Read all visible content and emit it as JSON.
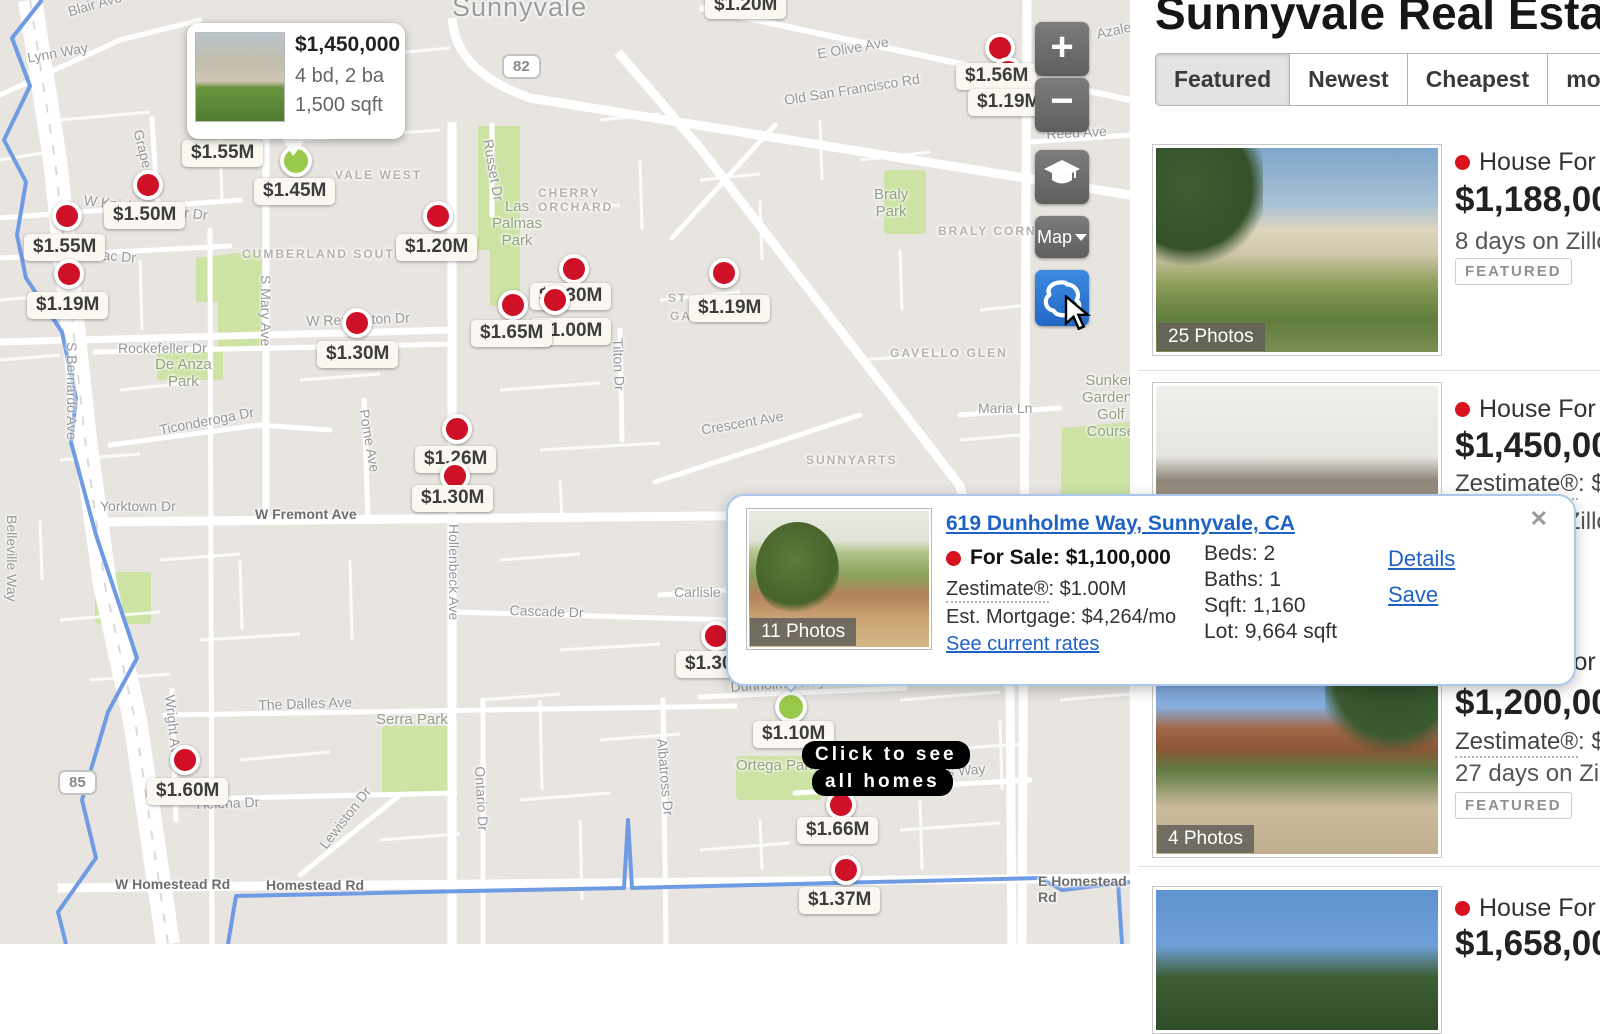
{
  "map": {
    "city": "Sunnyvale",
    "hover_card": {
      "price": "$1,450,000",
      "beds_baths": "4 bd, 2 ba",
      "sqft": "1,500 sqft"
    },
    "click_tooltip": {
      "line1": "Click to see",
      "line2": "all homes"
    },
    "controls": {
      "zoom_in": "+",
      "zoom_out": "−",
      "map_type": "Map"
    },
    "shields": [
      {
        "text": "82",
        "x": 502,
        "y": 54
      },
      {
        "text": "85",
        "x": 58,
        "y": 770
      }
    ],
    "labels": [
      {
        "text": "Blair Ave",
        "x": 66,
        "y": 4,
        "rot": -16,
        "kind": "street"
      },
      {
        "text": "Lynn Way",
        "x": 26,
        "y": 50,
        "rot": -10,
        "kind": "street"
      },
      {
        "text": "Grape Ave",
        "x": 146,
        "y": 128,
        "rot": 76,
        "kind": "street"
      },
      {
        "text": "W Knickerbocker Dr",
        "x": 85,
        "y": 192,
        "rot": 7,
        "kind": "street"
      },
      {
        "text": "Merrimac Dr",
        "x": 60,
        "y": 243,
        "rot": 5,
        "kind": "street"
      },
      {
        "text": "S Bernardo Ave",
        "x": 80,
        "y": 342,
        "rot": 90,
        "kind": "street"
      },
      {
        "text": "Rockefeller Dr",
        "x": 118,
        "y": 340,
        "rot": 0,
        "kind": "street"
      },
      {
        "text": "De Anza\nPark",
        "x": 155,
        "y": 356,
        "rot": 0,
        "kind": "park"
      },
      {
        "text": "Ticonderoga Dr",
        "x": 158,
        "y": 422,
        "rot": -11,
        "kind": "street"
      },
      {
        "text": "Yorktown Dr",
        "x": 100,
        "y": 498,
        "rot": 0,
        "kind": "street"
      },
      {
        "text": "W Fremont Ave",
        "x": 255,
        "y": 506,
        "rot": 0,
        "kind": "street-dark"
      },
      {
        "text": "Belleville Way",
        "x": 20,
        "y": 515,
        "rot": 90,
        "kind": "street"
      },
      {
        "text": "S Mary Ave",
        "x": 274,
        "y": 275,
        "rot": 90,
        "kind": "street"
      },
      {
        "text": "Pome Ave",
        "x": 372,
        "y": 408,
        "rot": 80,
        "kind": "street"
      },
      {
        "text": "Hollenbeck Ave",
        "x": 462,
        "y": 524,
        "rot": 90,
        "kind": "street"
      },
      {
        "text": "Cascade Dr",
        "x": 510,
        "y": 602,
        "rot": 2,
        "kind": "street"
      },
      {
        "text": "Carlisle",
        "x": 674,
        "y": 584,
        "rot": 0,
        "kind": "street"
      },
      {
        "text": "The Dalles Ave",
        "x": 258,
        "y": 697,
        "rot": -2,
        "kind": "street"
      },
      {
        "text": "Serra Park",
        "x": 376,
        "y": 711,
        "rot": 0,
        "kind": "park"
      },
      {
        "text": "Wright Ave",
        "x": 178,
        "y": 694,
        "rot": 84,
        "kind": "street"
      },
      {
        "text": "Helena Dr",
        "x": 196,
        "y": 796,
        "rot": -2,
        "kind": "street"
      },
      {
        "text": "Lewiston Dr",
        "x": 316,
        "y": 842,
        "rot": -52,
        "kind": "street"
      },
      {
        "text": "W Homestead Rd",
        "x": 115,
        "y": 876,
        "rot": 0,
        "kind": "street-dark"
      },
      {
        "text": "Homestead Rd",
        "x": 266,
        "y": 877,
        "rot": 0,
        "kind": "street-dark"
      },
      {
        "text": "Ontario Dr",
        "x": 488,
        "y": 766,
        "rot": 87,
        "kind": "street"
      },
      {
        "text": "Albatross Dr",
        "x": 670,
        "y": 738,
        "rot": 85,
        "kind": "street"
      },
      {
        "text": "Dunholme Way",
        "x": 730,
        "y": 679,
        "rot": -4,
        "kind": "street"
      },
      {
        "text": "Ortega Park",
        "x": 736,
        "y": 757,
        "rot": 0,
        "kind": "park"
      },
      {
        "text": "Inverness Way",
        "x": 893,
        "y": 767,
        "rot": -4,
        "kind": "street"
      },
      {
        "text": "E Homestead Rd",
        "x": 1038,
        "y": 873,
        "rot": 0,
        "kind": "street-dark"
      },
      {
        "text": "Tilton Dr",
        "x": 626,
        "y": 338,
        "rot": 88,
        "kind": "street"
      },
      {
        "text": "Russet Dr",
        "x": 496,
        "y": 138,
        "rot": 80,
        "kind": "street"
      },
      {
        "text": "Las\nPalmas\nPark",
        "x": 492,
        "y": 198,
        "rot": 0,
        "kind": "park"
      },
      {
        "text": "CHERRY\nORCHARD",
        "x": 538,
        "y": 186,
        "rot": 0,
        "kind": "area"
      },
      {
        "text": "Braly\nPark",
        "x": 874,
        "y": 186,
        "rot": 0,
        "kind": "park"
      },
      {
        "text": "BRALY CORNERS",
        "x": 938,
        "y": 224,
        "rot": 0,
        "kind": "area"
      },
      {
        "text": "GAVELLO GLEN",
        "x": 890,
        "y": 346,
        "rot": 0,
        "kind": "area"
      },
      {
        "text": "Maria Ln",
        "x": 978,
        "y": 400,
        "rot": 0,
        "kind": "street"
      },
      {
        "text": "Crescent Ave",
        "x": 700,
        "y": 422,
        "rot": -10,
        "kind": "street"
      },
      {
        "text": "SUNNYARTS",
        "x": 806,
        "y": 453,
        "rot": 0,
        "kind": "area"
      },
      {
        "text": "Sunken\nGardens\nGolf\nCourse",
        "x": 1082,
        "y": 372,
        "rot": 0,
        "kind": "park"
      },
      {
        "text": "E Olive Ave",
        "x": 816,
        "y": 46,
        "rot": -10,
        "kind": "street"
      },
      {
        "text": "Old San Francisco Rd",
        "x": 783,
        "y": 92,
        "rot": -9,
        "kind": "street"
      },
      {
        "text": "Reed Ave",
        "x": 1046,
        "y": 126,
        "rot": -3,
        "kind": "street"
      },
      {
        "text": "Azalea",
        "x": 1095,
        "y": 26,
        "rot": -12,
        "kind": "street"
      },
      {
        "text": "VALE WEST",
        "x": 335,
        "y": 168,
        "rot": 0,
        "k": "",
        "kind": "area"
      },
      {
        "text": "CUMBERLAND SOUTH",
        "x": 242,
        "y": 247,
        "rot": 0,
        "kind": "area"
      },
      {
        "text": "ST",
        "x": 668,
        "y": 291,
        "rot": 0,
        "kind": "area"
      },
      {
        "text": "GARDENS",
        "x": 670,
        "y": 309,
        "rot": 0,
        "kind": "area"
      },
      {
        "text": "W Remington Dr",
        "x": 306,
        "y": 313,
        "rot": -2,
        "kind": "street"
      },
      {
        "text": "Sunnyvale",
        "x": 452,
        "y": -8,
        "rot": 0,
        "kind": "city"
      }
    ],
    "price_points": [
      {
        "kind": "chip",
        "text": "$1.20M",
        "x": 705,
        "y": -8
      },
      {
        "kind": "marker",
        "x": 1000,
        "y": 48,
        "color": "red"
      },
      {
        "kind": "marker",
        "x": 1008,
        "y": 72,
        "color": "red"
      },
      {
        "kind": "chip",
        "text": "$1.56M",
        "x": 956,
        "y": 63
      },
      {
        "kind": "chip",
        "text": "$1.19M",
        "x": 968,
        "y": 89
      },
      {
        "kind": "marker",
        "x": 148,
        "y": 185,
        "color": "red"
      },
      {
        "kind": "chip",
        "text": "$1.50M",
        "x": 104,
        "y": 202
      },
      {
        "kind": "marker",
        "x": 67,
        "y": 216,
        "color": "red"
      },
      {
        "kind": "chip",
        "text": "$1.55M",
        "x": 24,
        "y": 234
      },
      {
        "kind": "marker",
        "x": 69,
        "y": 274,
        "color": "red"
      },
      {
        "kind": "chip",
        "text": "$1.19M",
        "x": 27,
        "y": 292
      },
      {
        "kind": "chip",
        "text": "$1.55M",
        "x": 182,
        "y": 140
      },
      {
        "kind": "marker",
        "x": 296,
        "y": 161,
        "color": "green"
      },
      {
        "kind": "chip",
        "text": "$1.45M",
        "x": 254,
        "y": 178
      },
      {
        "kind": "marker",
        "x": 438,
        "y": 216,
        "color": "red"
      },
      {
        "kind": "chip",
        "text": "$1.20M",
        "x": 396,
        "y": 234
      },
      {
        "kind": "marker",
        "x": 574,
        "y": 269,
        "color": "red"
      },
      {
        "kind": "chip",
        "text": "$1.30M",
        "x": 530,
        "y": 283
      },
      {
        "kind": "marker",
        "x": 555,
        "y": 300,
        "color": "red"
      },
      {
        "kind": "marker",
        "x": 513,
        "y": 305,
        "color": "red"
      },
      {
        "kind": "chip",
        "text": "$1.00M",
        "x": 530,
        "y": 318
      },
      {
        "kind": "chip",
        "text": "$1.65M",
        "x": 471,
        "y": 320
      },
      {
        "kind": "marker",
        "x": 724,
        "y": 273,
        "color": "red"
      },
      {
        "kind": "chip",
        "text": "$1.19M",
        "x": 689,
        "y": 295
      },
      {
        "kind": "marker",
        "x": 357,
        "y": 323,
        "color": "red"
      },
      {
        "kind": "chip",
        "text": "$1.30M",
        "x": 317,
        "y": 341
      },
      {
        "kind": "marker",
        "x": 457,
        "y": 429,
        "color": "red"
      },
      {
        "kind": "chip",
        "text": "$1.26M",
        "x": 415,
        "y": 446
      },
      {
        "kind": "marker",
        "x": 455,
        "y": 476,
        "color": "red"
      },
      {
        "kind": "chip",
        "text": "$1.30M",
        "x": 412,
        "y": 485
      },
      {
        "kind": "marker",
        "x": 185,
        "y": 760,
        "color": "red"
      },
      {
        "kind": "chip",
        "text": "$1.60M",
        "x": 147,
        "y": 778
      },
      {
        "kind": "marker",
        "x": 716,
        "y": 636,
        "color": "red"
      },
      {
        "kind": "chip",
        "text": "$1.30M",
        "x": 676,
        "y": 651
      },
      {
        "kind": "marker",
        "x": 791,
        "y": 707,
        "color": "green"
      },
      {
        "kind": "chip",
        "text": "$1.10M",
        "x": 753,
        "y": 721
      },
      {
        "kind": "marker",
        "x": 841,
        "y": 805,
        "color": "red"
      },
      {
        "kind": "chip",
        "text": "$1.66M",
        "x": 797,
        "y": 817
      },
      {
        "kind": "marker",
        "x": 846,
        "y": 870,
        "color": "red"
      },
      {
        "kind": "chip",
        "text": "$1.37M",
        "x": 799,
        "y": 887
      }
    ]
  },
  "popup": {
    "address": "619 Dunholme Way, Sunnyvale, CA",
    "photos_overlay": "11 Photos",
    "status": "For Sale:",
    "price": "$1,100,000",
    "zestimate_label": "Zestimate®",
    "zestimate_value": ": $1.00M",
    "mortgage": "Est. Mortgage: $4,264/mo",
    "rates_link": "See current rates",
    "beds": "Beds: 2",
    "baths": "Baths: 1",
    "sqft": "Sqft: 1,160",
    "lot": "Lot: 9,664 sqft",
    "details_link": "Details",
    "save_link": "Save",
    "close": "✕"
  },
  "sidebar": {
    "title": "Sunnyvale Real Estate",
    "tabs": [
      {
        "label": "Featured",
        "active": true
      },
      {
        "label": "Newest"
      },
      {
        "label": "Cheapest"
      },
      {
        "label": "more"
      }
    ],
    "listings": [
      {
        "status": "House For Sale",
        "price": "$1,188,000",
        "meta": "8 days on Zillow",
        "badge": "FEATURED",
        "photos": "25 Photos"
      },
      {
        "status": "House For Sale",
        "price": "$1,450,000",
        "zestimate_label": "Zestimate®",
        "zestimate_value": ": $1",
        "meta": "8 days on Zillow"
      },
      {
        "status": "House For Sale",
        "price": "$1,200,000",
        "zestimate_label": "Zestimate®",
        "zestimate_value": ": $1",
        "meta": "27 days on Zillow",
        "badge": "FEATURED",
        "photos": "4 Photos"
      },
      {
        "status": "House For Sale",
        "price": "$1,658,000"
      }
    ]
  }
}
